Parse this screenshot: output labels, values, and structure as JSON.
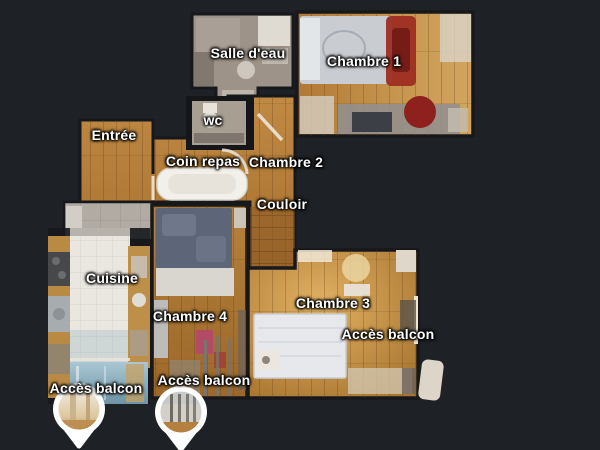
{
  "floorplan": {
    "background_color": "#1e2126",
    "wall_color": "#16181c",
    "label_text_color": "#ffffff",
    "rooms": [
      {
        "id": "salle-deau",
        "label": "Salle d'eau",
        "floor": "tile-gray"
      },
      {
        "id": "chambre-1",
        "label": "Chambre 1",
        "floor": "wood"
      },
      {
        "id": "wc",
        "label": "wc",
        "floor": "tile-gray"
      },
      {
        "id": "entree",
        "label": "Entrée",
        "floor": "wood"
      },
      {
        "id": "coin-repas",
        "label": "Coin repas",
        "floor": "wood"
      },
      {
        "id": "chambre-2",
        "label": "Chambre 2",
        "floor": "wood"
      },
      {
        "id": "couloir",
        "label": "Couloir",
        "floor": "wood"
      },
      {
        "id": "cuisine",
        "label": "Cuisine",
        "floor": "tile-white"
      },
      {
        "id": "chambre-4",
        "label": "Chambre 4",
        "floor": "wood"
      },
      {
        "id": "chambre-3",
        "label": "Chambre 3",
        "floor": "wood"
      }
    ],
    "balcony_markers": [
      {
        "id": "acces-balcon-chambre-3",
        "label": "Accès balcon",
        "pin": false
      },
      {
        "id": "acces-balcon-cuisine",
        "label": "Accès balcon",
        "pin": true
      },
      {
        "id": "acces-balcon-chambre-4",
        "label": "Accès balcon",
        "pin": true
      }
    ],
    "colors": {
      "wood_light": "#cf9f5a",
      "wood_mid": "#b5823c",
      "wood_dark": "#8a5726",
      "balcony_floor_blue": "#7fa5b7",
      "pin_fill": "#ffffff"
    }
  }
}
